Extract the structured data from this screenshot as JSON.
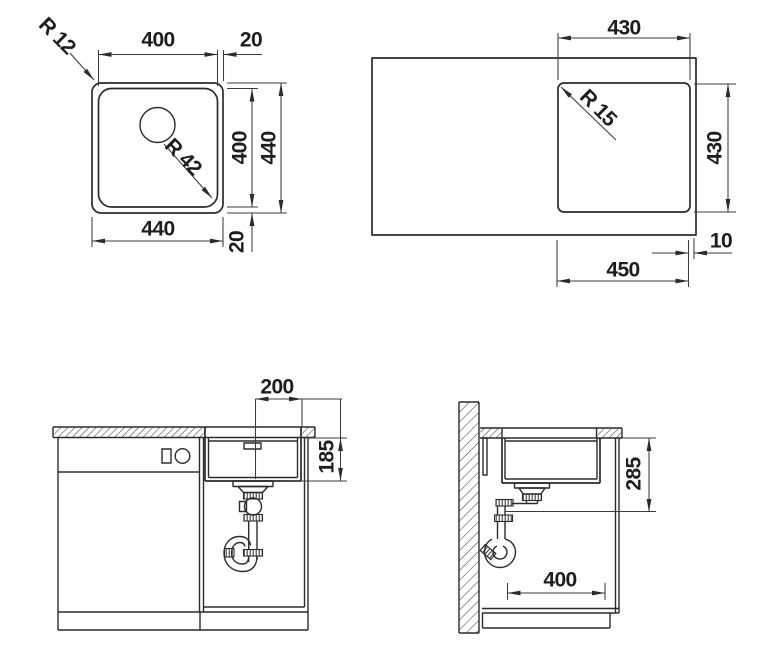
{
  "meta": {
    "description": "Technical installation drawing of an undermount kitchen sink: plan view, worktop cutout view, front section and side section",
    "ink_color": "#2b2b2b",
    "background_color": "#ffffff"
  },
  "fig_top_view": {
    "dim_width_inner": "400",
    "dim_rim_top": "20",
    "radius_corner": "R 12",
    "radius_bowl": "R 42",
    "dim_height_inner": "400",
    "dim_height_outer": "440",
    "dim_width_outer": "440",
    "dim_rim_bottom": "20"
  },
  "fig_cutout_view": {
    "dim_cutout_width": "430",
    "radius_cutout": "R 15",
    "dim_cutout_height": "430",
    "dim_edge_gap": "10",
    "dim_sink_width": "450"
  },
  "fig_front_view": {
    "dim_drain_offset": "200",
    "dim_bowl_depth": "185"
  },
  "fig_side_view": {
    "dim_drain_height": "285",
    "dim_depth": "400"
  }
}
